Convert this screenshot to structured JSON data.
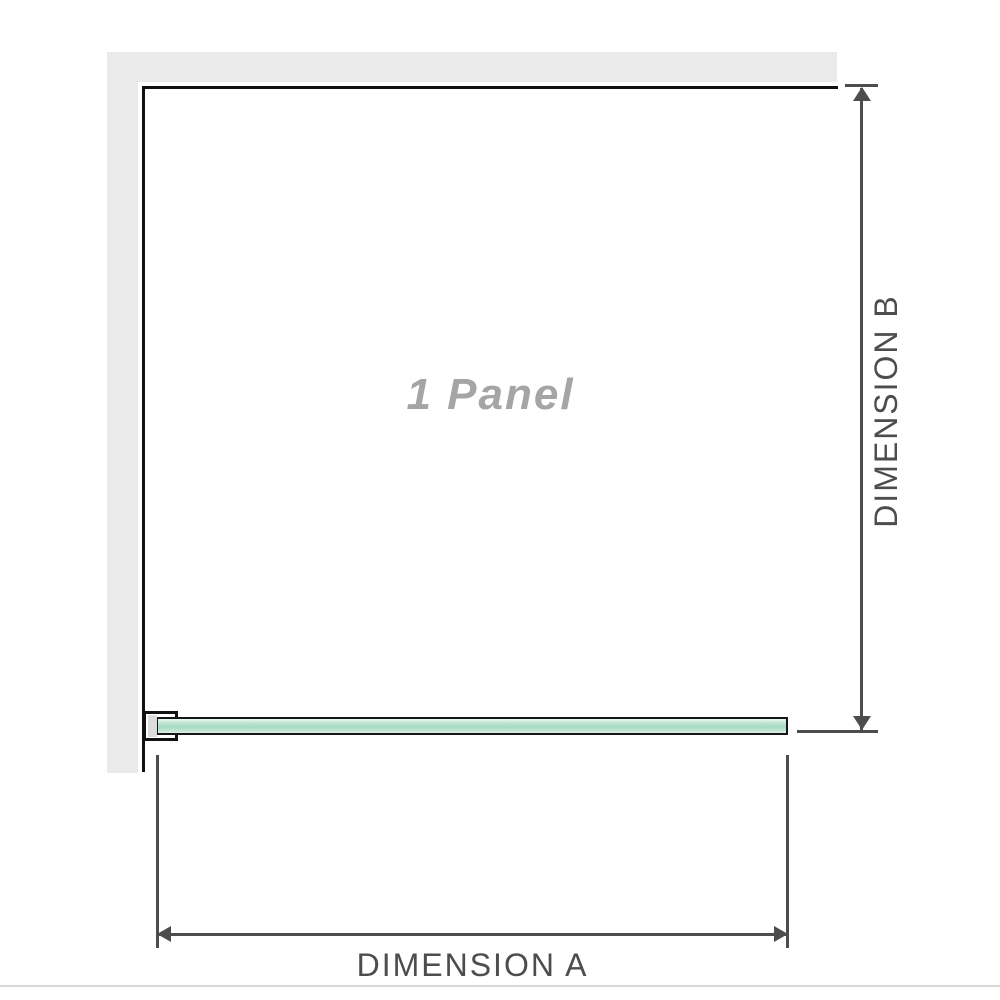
{
  "diagram": {
    "panel_label": "1 Panel",
    "dimensions": {
      "a_label": "DIMENSION A",
      "b_label": "DIMENSION B"
    },
    "colors": {
      "wall_gray": "#eaeaea",
      "frame_black": "#111111",
      "dimension_line_gray": "#4d4d4d",
      "panel_label_gray": "#a5a5a5",
      "bracket_insert_gray": "#dcdcdc",
      "glass_green_light": "#daf0e4",
      "glass_green_mid": "#a8dac2"
    },
    "icons": {
      "arrow_up": "css-triangle-up",
      "arrow_down": "css-triangle-down",
      "arrow_left": "css-triangle-left",
      "arrow_right": "css-triangle-right"
    }
  }
}
